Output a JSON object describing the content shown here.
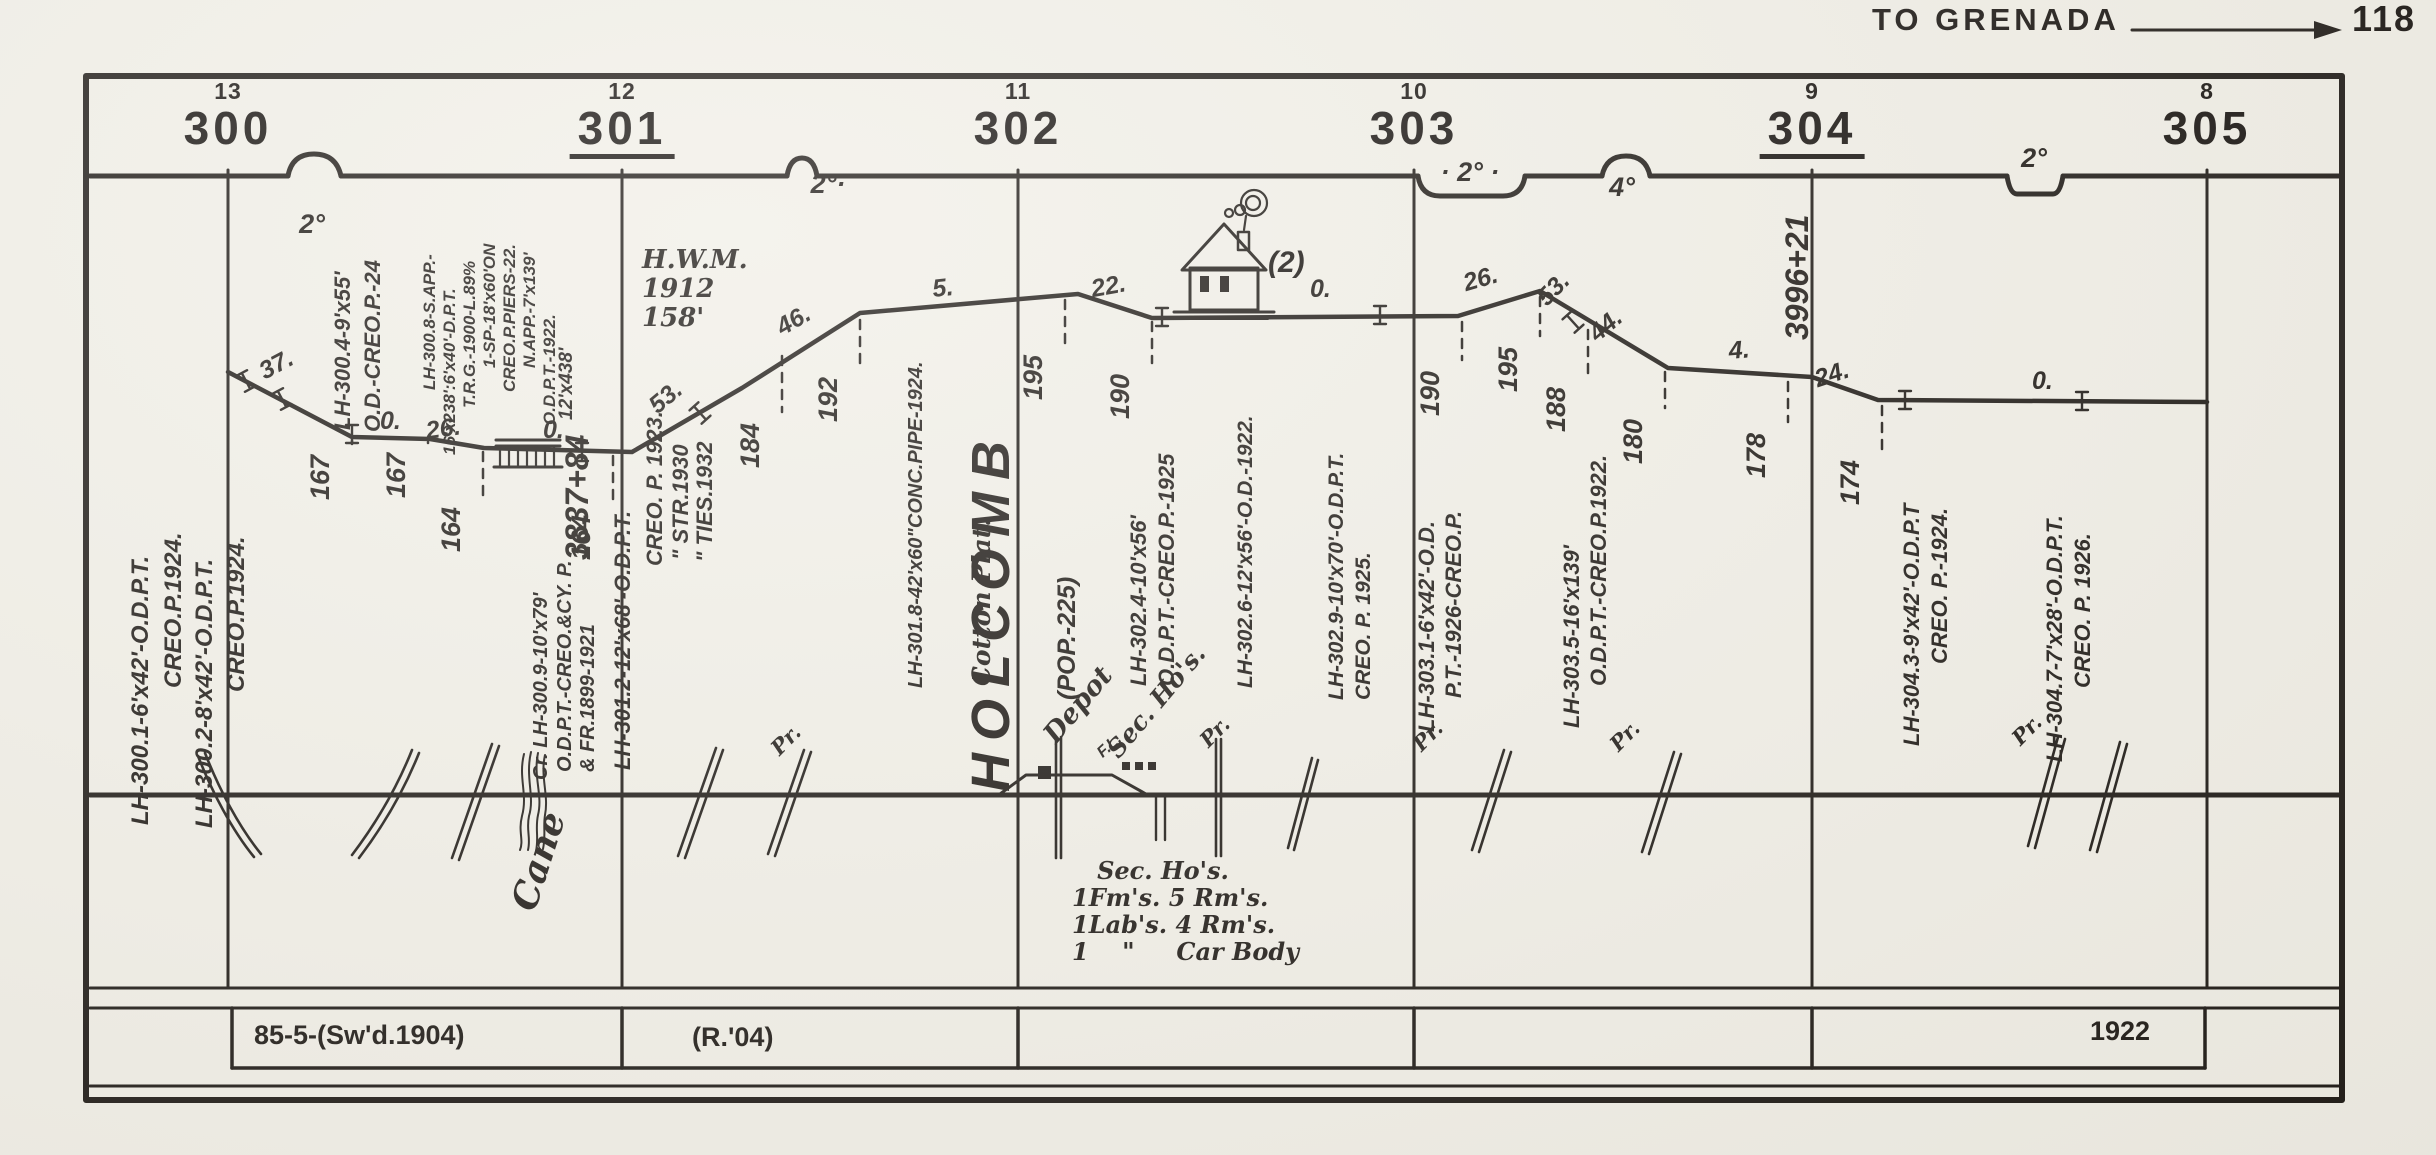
{
  "header": {
    "destination": "TO GRENADA",
    "page": "118"
  },
  "house": {
    "label": "(2)"
  },
  "mileposts": [
    {
      "x": 228,
      "mile": "300",
      "station": "13",
      "underline": false
    },
    {
      "x": 622,
      "mile": "301",
      "station": "12",
      "underline": true
    },
    {
      "x": 1018,
      "mile": "302",
      "station": "11",
      "underline": false
    },
    {
      "x": 1414,
      "mile": "303",
      "station": "10",
      "underline": false
    },
    {
      "x": 1812,
      "mile": "304",
      "station": "9",
      "underline": true
    },
    {
      "x": 2207,
      "mile": "305",
      "station": "8",
      "underline": false
    }
  ],
  "profile_points": "228,372 352,437 430,439 484,448 632,452 742,388 860,313 1078,294 1152,318 1458,316 1540,291 1585,318 1668,368 1812,377 1878,400 2207,402",
  "curves": [
    {
      "x": 312,
      "y": 240,
      "t": "2°"
    },
    {
      "x": 828,
      "y": 200,
      "t": "2°·"
    },
    {
      "x": 1470,
      "y": 188,
      "t": "· 2° ·"
    },
    {
      "x": 1622,
      "y": 203,
      "t": "4°"
    },
    {
      "x": 2034,
      "y": 174,
      "t": "2°"
    }
  ],
  "grades": [
    {
      "x": 268,
      "y": 386,
      "t": "37.",
      "r": -28
    },
    {
      "x": 380,
      "y": 436,
      "t": "0.",
      "r": 0
    },
    {
      "x": 428,
      "y": 446,
      "t": "26.",
      "r": -8
    },
    {
      "x": 543,
      "y": 445,
      "t": "0.",
      "r": 0
    },
    {
      "x": 662,
      "y": 420,
      "t": "53.",
      "r": -40
    },
    {
      "x": 786,
      "y": 342,
      "t": "46.",
      "r": -30
    },
    {
      "x": 934,
      "y": 304,
      "t": "5.",
      "r": -6
    },
    {
      "x": 1094,
      "y": 304,
      "t": "22.",
      "r": -10
    },
    {
      "x": 1310,
      "y": 304,
      "t": "0.",
      "r": 0
    },
    {
      "x": 1468,
      "y": 298,
      "t": "26.",
      "r": -16
    },
    {
      "x": 1552,
      "y": 312,
      "t": "53.",
      "r": -46
    },
    {
      "x": 1602,
      "y": 348,
      "t": "44.",
      "r": -40
    },
    {
      "x": 1730,
      "y": 366,
      "t": "4.",
      "r": -5
    },
    {
      "x": 1820,
      "y": 394,
      "t": "24.",
      "r": -18
    },
    {
      "x": 2032,
      "y": 396,
      "t": "0.",
      "r": 0
    }
  ],
  "elevations": [
    {
      "x": 352,
      "y1": 441,
      "y2": 500,
      "v": "167"
    },
    {
      "x": 428,
      "y1": 443,
      "y2": 498,
      "v": "167"
    },
    {
      "x": 483,
      "y1": 452,
      "y2": 552,
      "v": "164"
    },
    {
      "x": 613,
      "y1": 456,
      "y2": 560,
      "v": "164"
    },
    {
      "x": 782,
      "y1": 356,
      "y2": 468,
      "v": "184"
    },
    {
      "x": 860,
      "y1": 320,
      "y2": 422,
      "v": "192"
    },
    {
      "x": 1065,
      "y1": 300,
      "y2": 400,
      "v": "195"
    },
    {
      "x": 1152,
      "y1": 322,
      "y2": 419,
      "v": "190"
    },
    {
      "x": 1462,
      "y1": 322,
      "y2": 416,
      "v": "190"
    },
    {
      "x": 1540,
      "y1": 297,
      "y2": 392,
      "v": "195"
    },
    {
      "x": 1588,
      "y1": 330,
      "y2": 432,
      "v": "188"
    },
    {
      "x": 1665,
      "y1": 372,
      "y2": 464,
      "v": "180"
    },
    {
      "x": 1788,
      "y1": 382,
      "y2": 478,
      "v": "178"
    },
    {
      "x": 1882,
      "y1": 406,
      "y2": 505,
      "v": "174"
    }
  ],
  "culverts": [
    {
      "x": 246,
      "y": 381,
      "r": -28
    },
    {
      "x": 282,
      "y": 399,
      "r": -28
    },
    {
      "x": 352,
      "y": 434,
      "r": 0
    },
    {
      "x": 582,
      "y": 452,
      "r": 0
    },
    {
      "x": 700,
      "y": 413,
      "r": -42
    },
    {
      "x": 1162,
      "y": 317,
      "r": 0
    },
    {
      "x": 1380,
      "y": 315,
      "r": 0
    },
    {
      "x": 1573,
      "y": 322,
      "r": -42
    },
    {
      "x": 1905,
      "y": 400,
      "r": 0
    },
    {
      "x": 2082,
      "y": 401,
      "r": 0
    }
  ],
  "annotations": [
    {
      "x": 155,
      "y": 825,
      "t": "LH-300.1-6'x42'-O.D.P.T.",
      "fs": 24
    },
    {
      "x": 188,
      "y": 688,
      "t": "CREO.P.1924.",
      "fs": 24
    },
    {
      "x": 219,
      "y": 828,
      "t": "LH-300.2-8'x42'-O.D.P.T.",
      "fs": 24
    },
    {
      "x": 251,
      "y": 692,
      "t": "CREO.P.1924.",
      "fs": 24
    },
    {
      "x": 356,
      "y": 430,
      "t": "LH-300.4-9'x55'",
      "fs": 22
    },
    {
      "x": 386,
      "y": 432,
      "t": "O.D.-CREO.P.-24",
      "fs": 22
    },
    {
      "x": 440,
      "y": 390,
      "t": "LH-300.8-S.APP.-",
      "fs": 17
    },
    {
      "x": 460,
      "y": 455,
      "t": "16'x238':6'x40'-D.P.T.",
      "fs": 17
    },
    {
      "x": 480,
      "y": 408,
      "t": "T.R.G.-1900-L.89%",
      "fs": 17
    },
    {
      "x": 500,
      "y": 368,
      "t": "1-SP-18'x60'ON",
      "fs": 17
    },
    {
      "x": 520,
      "y": 392,
      "t": "CREO.P.PIERS-22.",
      "fs": 17
    },
    {
      "x": 540,
      "y": 368,
      "t": "N.APP.-7'x139'",
      "fs": 17
    },
    {
      "x": 560,
      "y": 425,
      "t": "O.D.P.T.-1922.",
      "fs": 17
    },
    {
      "x": 578,
      "y": 420,
      "t": "12'x438'",
      "fs": 19
    },
    {
      "x": 596,
      "y": 560,
      "t": "3837+84",
      "fs": 32
    },
    {
      "x": 553,
      "y": 780,
      "t": "Cr. LH-300.9-10'x79'",
      "fs": 20
    },
    {
      "x": 577,
      "y": 772,
      "t": "O.D.P.T.-CREO.&CY. P.",
      "fs": 20
    },
    {
      "x": 600,
      "y": 772,
      "t": "& FR.1899-1921",
      "fs": 20
    },
    {
      "x": 636,
      "y": 770,
      "t": "LH-301.2-12'x68'-O.D.P.T.",
      "fs": 22
    },
    {
      "x": 668,
      "y": 566,
      "t": "CREO. P. 1923.",
      "fs": 22
    },
    {
      "x": 694,
      "y": 560,
      "t": "\" STR.1930",
      "fs": 22
    },
    {
      "x": 718,
      "y": 562,
      "t": "\" TIES.1932",
      "fs": 22
    },
    {
      "x": 928,
      "y": 688,
      "t": "LH-301.8-42'x60\"CONC.PIPE-1924.",
      "fs": 20
    },
    {
      "x": 997,
      "y": 686,
      "t": "Cotton Plat.",
      "fs": 25,
      "serif": true
    },
    {
      "x": 1024,
      "y": 792,
      "t": "HOLCOMB",
      "fs": 54,
      "ls": 12
    },
    {
      "x": 1082,
      "y": 700,
      "t": "(POP.-225)",
      "fs": 25
    },
    {
      "x": 1152,
      "y": 686,
      "t": "LH-302.4-10'x56'",
      "fs": 22
    },
    {
      "x": 1180,
      "y": 686,
      "t": "O.D.P.T.-CREO.P.-1925",
      "fs": 22
    },
    {
      "x": 1258,
      "y": 688,
      "t": "LH-302.6-12'x56'-O.D.-1922.",
      "fs": 21
    },
    {
      "x": 1349,
      "y": 700,
      "t": "LH-302.9-10'x70'-O.D.P.T.",
      "fs": 21
    },
    {
      "x": 1376,
      "y": 700,
      "t": "CREO. P. 1925.",
      "fs": 21
    },
    {
      "x": 1440,
      "y": 732,
      "t": "LH-303.1-6'x42'-O.D.",
      "fs": 22
    },
    {
      "x": 1467,
      "y": 698,
      "t": "P.T.-1926-CREO.P.",
      "fs": 22
    },
    {
      "x": 1585,
      "y": 728,
      "t": "LH-303.5-16'x139'",
      "fs": 22
    },
    {
      "x": 1612,
      "y": 686,
      "t": "O.D.P.T.-CREO.P.1922.",
      "fs": 22
    },
    {
      "x": 1816,
      "y": 340,
      "t": "3996+21",
      "fs": 32
    },
    {
      "x": 1925,
      "y": 746,
      "t": "LH-304.3-9'x42'-O.D.P.T",
      "fs": 22
    },
    {
      "x": 1953,
      "y": 664,
      "t": "CREO. P.-1924.",
      "fs": 22
    },
    {
      "x": 2068,
      "y": 762,
      "t": "LH-304.7-7'x28'-O.D.P.T.",
      "fs": 22
    },
    {
      "x": 2096,
      "y": 688,
      "t": "CREO. P. 1926.",
      "fs": 22
    },
    {
      "x": 544,
      "y": 916,
      "t": "Cane",
      "fs": 36,
      "rot": -72,
      "serif": true
    },
    {
      "x": 1062,
      "y": 750,
      "t": "Depot",
      "fs": 27,
      "rot": -50,
      "serif": true
    },
    {
      "x": 1124,
      "y": 764,
      "t": "Sec. Ho's.",
      "fs": 25,
      "rot": -50,
      "serif": true
    },
    {
      "x": 1106,
      "y": 762,
      "t": "F.L.",
      "fs": 16,
      "rot": -42
    },
    {
      "x": 783,
      "y": 760,
      "t": "Pr.",
      "fs": 21,
      "rot": -45,
      "serif": true
    },
    {
      "x": 1212,
      "y": 752,
      "t": "Pr.",
      "fs": 21,
      "rot": -45,
      "serif": true
    },
    {
      "x": 1425,
      "y": 756,
      "t": "Pr.",
      "fs": 21,
      "rot": -45,
      "serif": true
    },
    {
      "x": 1622,
      "y": 756,
      "t": "Pr.",
      "fs": 21,
      "rot": -45,
      "serif": true
    },
    {
      "x": 2024,
      "y": 750,
      "t": "Pr.",
      "fs": 21,
      "rot": -45,
      "serif": true
    }
  ],
  "notes": [
    {
      "x": 642,
      "y": 246,
      "fs": 26,
      "lines": [
        "H.W.M.",
        "1912",
        "158'"
      ]
    },
    {
      "x": 1072,
      "y": 858,
      "fs": 24,
      "lines": [
        "   Sec. Ho's.",
        "1Fm's. 5 Rm's.",
        "1Lab's. 4 Rm's.",
        "1    \"     Car Body"
      ]
    }
  ],
  "band": {
    "labels": [
      {
        "x": 254,
        "y": 1020,
        "t": "85-5-(Sw'd.1904)"
      },
      {
        "x": 692,
        "y": 1022,
        "t": "(R.'04)"
      },
      {
        "x": 2090,
        "y": 1016,
        "t": "1922"
      }
    ]
  },
  "chart_data": {
    "type": "line",
    "title": "Railroad condensed profile, mileposts 300-305, Holcomb (POP. 225)",
    "xlabel": "Milepost",
    "ylabel": "Elevation (ft)",
    "x": [
      300.3,
      300.5,
      300.64,
      300.97,
      301.4,
      301.6,
      302.1,
      302.3,
      303.1,
      303.3,
      303.44,
      303.6,
      303.93,
      304.17
    ],
    "y": [
      167,
      167,
      164,
      164,
      184,
      192,
      195,
      190,
      190,
      195,
      188,
      180,
      178,
      174
    ],
    "grade_labels": [
      "37.",
      "0.",
      "26.",
      "0.",
      "53.",
      "46.",
      "5.",
      "22.",
      "0.",
      "26.",
      "53.",
      "44.",
      "4.",
      "24.",
      "0."
    ],
    "curve_degrees": [
      "2°",
      "2°",
      "2°",
      "4°",
      "2°"
    ],
    "milepost_stations": {
      "301": "3837+84",
      "304": "3996+21"
    }
  }
}
